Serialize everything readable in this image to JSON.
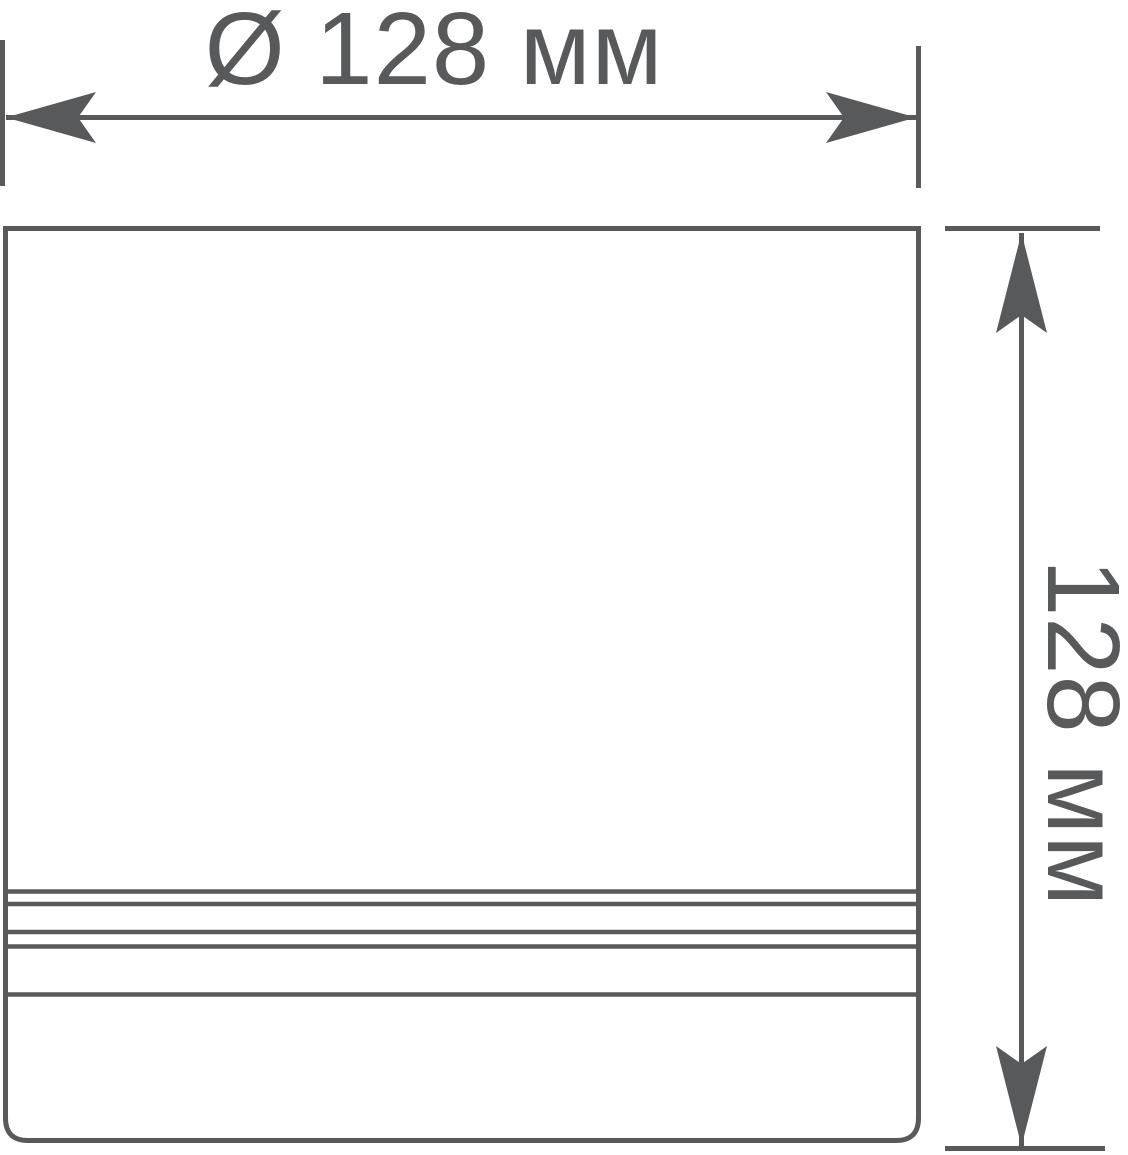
{
  "page": {
    "background_color": "#ffffff"
  },
  "drawing": {
    "kind": "product-dimension-drawing",
    "line_color": "#58595b",
    "diameter_dimension": {
      "symbol": "Ø",
      "value": "128",
      "unit": "мм",
      "label": "Ø 128 мм"
    },
    "height_dimension": {
      "value": "128",
      "unit": "мм",
      "label": "128 мм"
    }
  }
}
